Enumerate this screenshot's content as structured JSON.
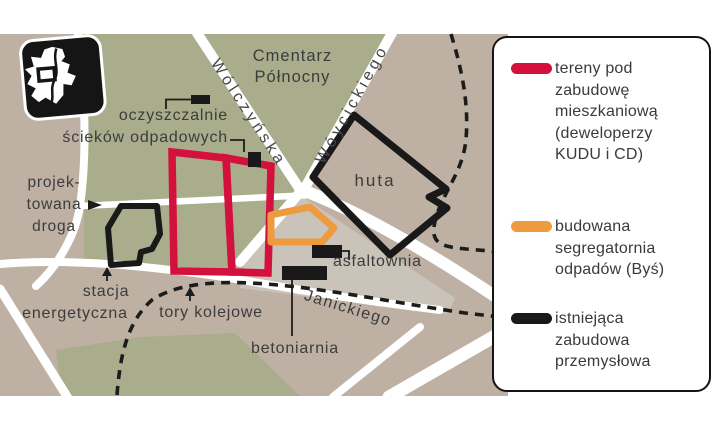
{
  "map": {
    "area_labels": {
      "cemetery": [
        "Cmentarz",
        "Północny"
      ],
      "huta": "huta"
    },
    "streets": [
      "Wólczyńska",
      "Wóycickiego",
      "Janickiego"
    ],
    "callouts": {
      "treatment_plant": [
        "oczyszczalnie",
        "ścieków odpadowych"
      ],
      "planned_road": [
        "projek-",
        "towana",
        "droga"
      ],
      "power_station": [
        "stacja",
        "energetyczna"
      ],
      "railway": "tory kolejowe",
      "asphalt_plant": "asfaltownia",
      "concrete_plant": "betoniarnia"
    },
    "inset_icon": "warsaw-districts-map-icon",
    "colors": {
      "green_area": "#a9ad8c",
      "ground": "#beb1a3",
      "industrial_ground": "#c9c3b9",
      "road": "#ffffff",
      "residential_outline": "#d4103c",
      "waste_sorting_outline": "#ee9b40",
      "industrial_outline": "#191919"
    }
  },
  "legend": {
    "items": [
      {
        "swatch_color": "#d4103c",
        "lines": [
          "tereny pod",
          "zabudowę",
          "mieszkaniową",
          "(deweloperzy",
          "KUDU i CD)"
        ]
      },
      {
        "swatch_color": "#ee9b40",
        "lines": [
          "budowana",
          "segregatornia",
          "odpadów (Byś)"
        ]
      },
      {
        "swatch_color": "#191919",
        "lines": [
          "istniejąca",
          "zabudowa",
          "przemysłowa"
        ]
      }
    ]
  }
}
